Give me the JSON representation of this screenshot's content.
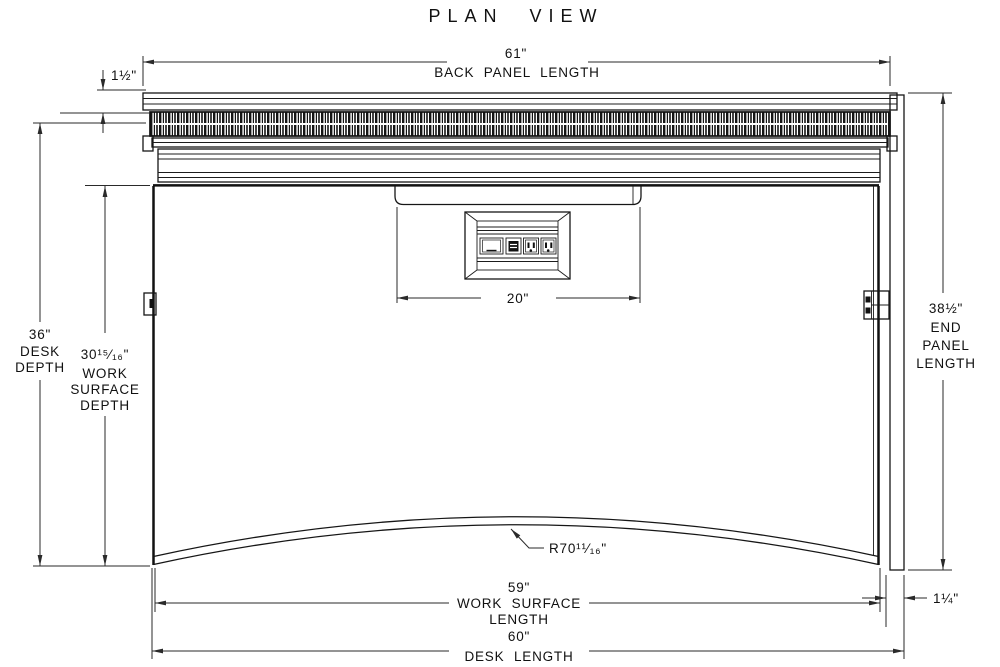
{
  "title": "PLAN VIEW",
  "dims": {
    "back_panel_length": {
      "value": "61\"",
      "label": "BACK PANEL LENGTH"
    },
    "back_offset": {
      "value": "1½\""
    },
    "desk_depth": {
      "value": "36\"",
      "line1": "DESK",
      "line2": "DEPTH"
    },
    "work_surface_depth": {
      "value": "30¹⁵⁄₁₆\"",
      "line1": "WORK",
      "line2": "SURFACE",
      "line3": "DEPTH"
    },
    "end_panel_length": {
      "value": "38½\"",
      "line1": "END",
      "line2": "PANEL",
      "line3": "LENGTH"
    },
    "grommet_width": {
      "value": "20\""
    },
    "front_radius": {
      "value": "R70¹¹⁄₁₆\""
    },
    "work_surface_length": {
      "value": "59\"",
      "line1": "WORK SURFACE",
      "line2": "LENGTH"
    },
    "desk_length": {
      "value": "60\"",
      "label": "DESK LENGTH"
    },
    "end_panel_offset": {
      "value": "1¼\""
    }
  },
  "colors": {
    "ink": "#111111",
    "background": "#ffffff"
  }
}
